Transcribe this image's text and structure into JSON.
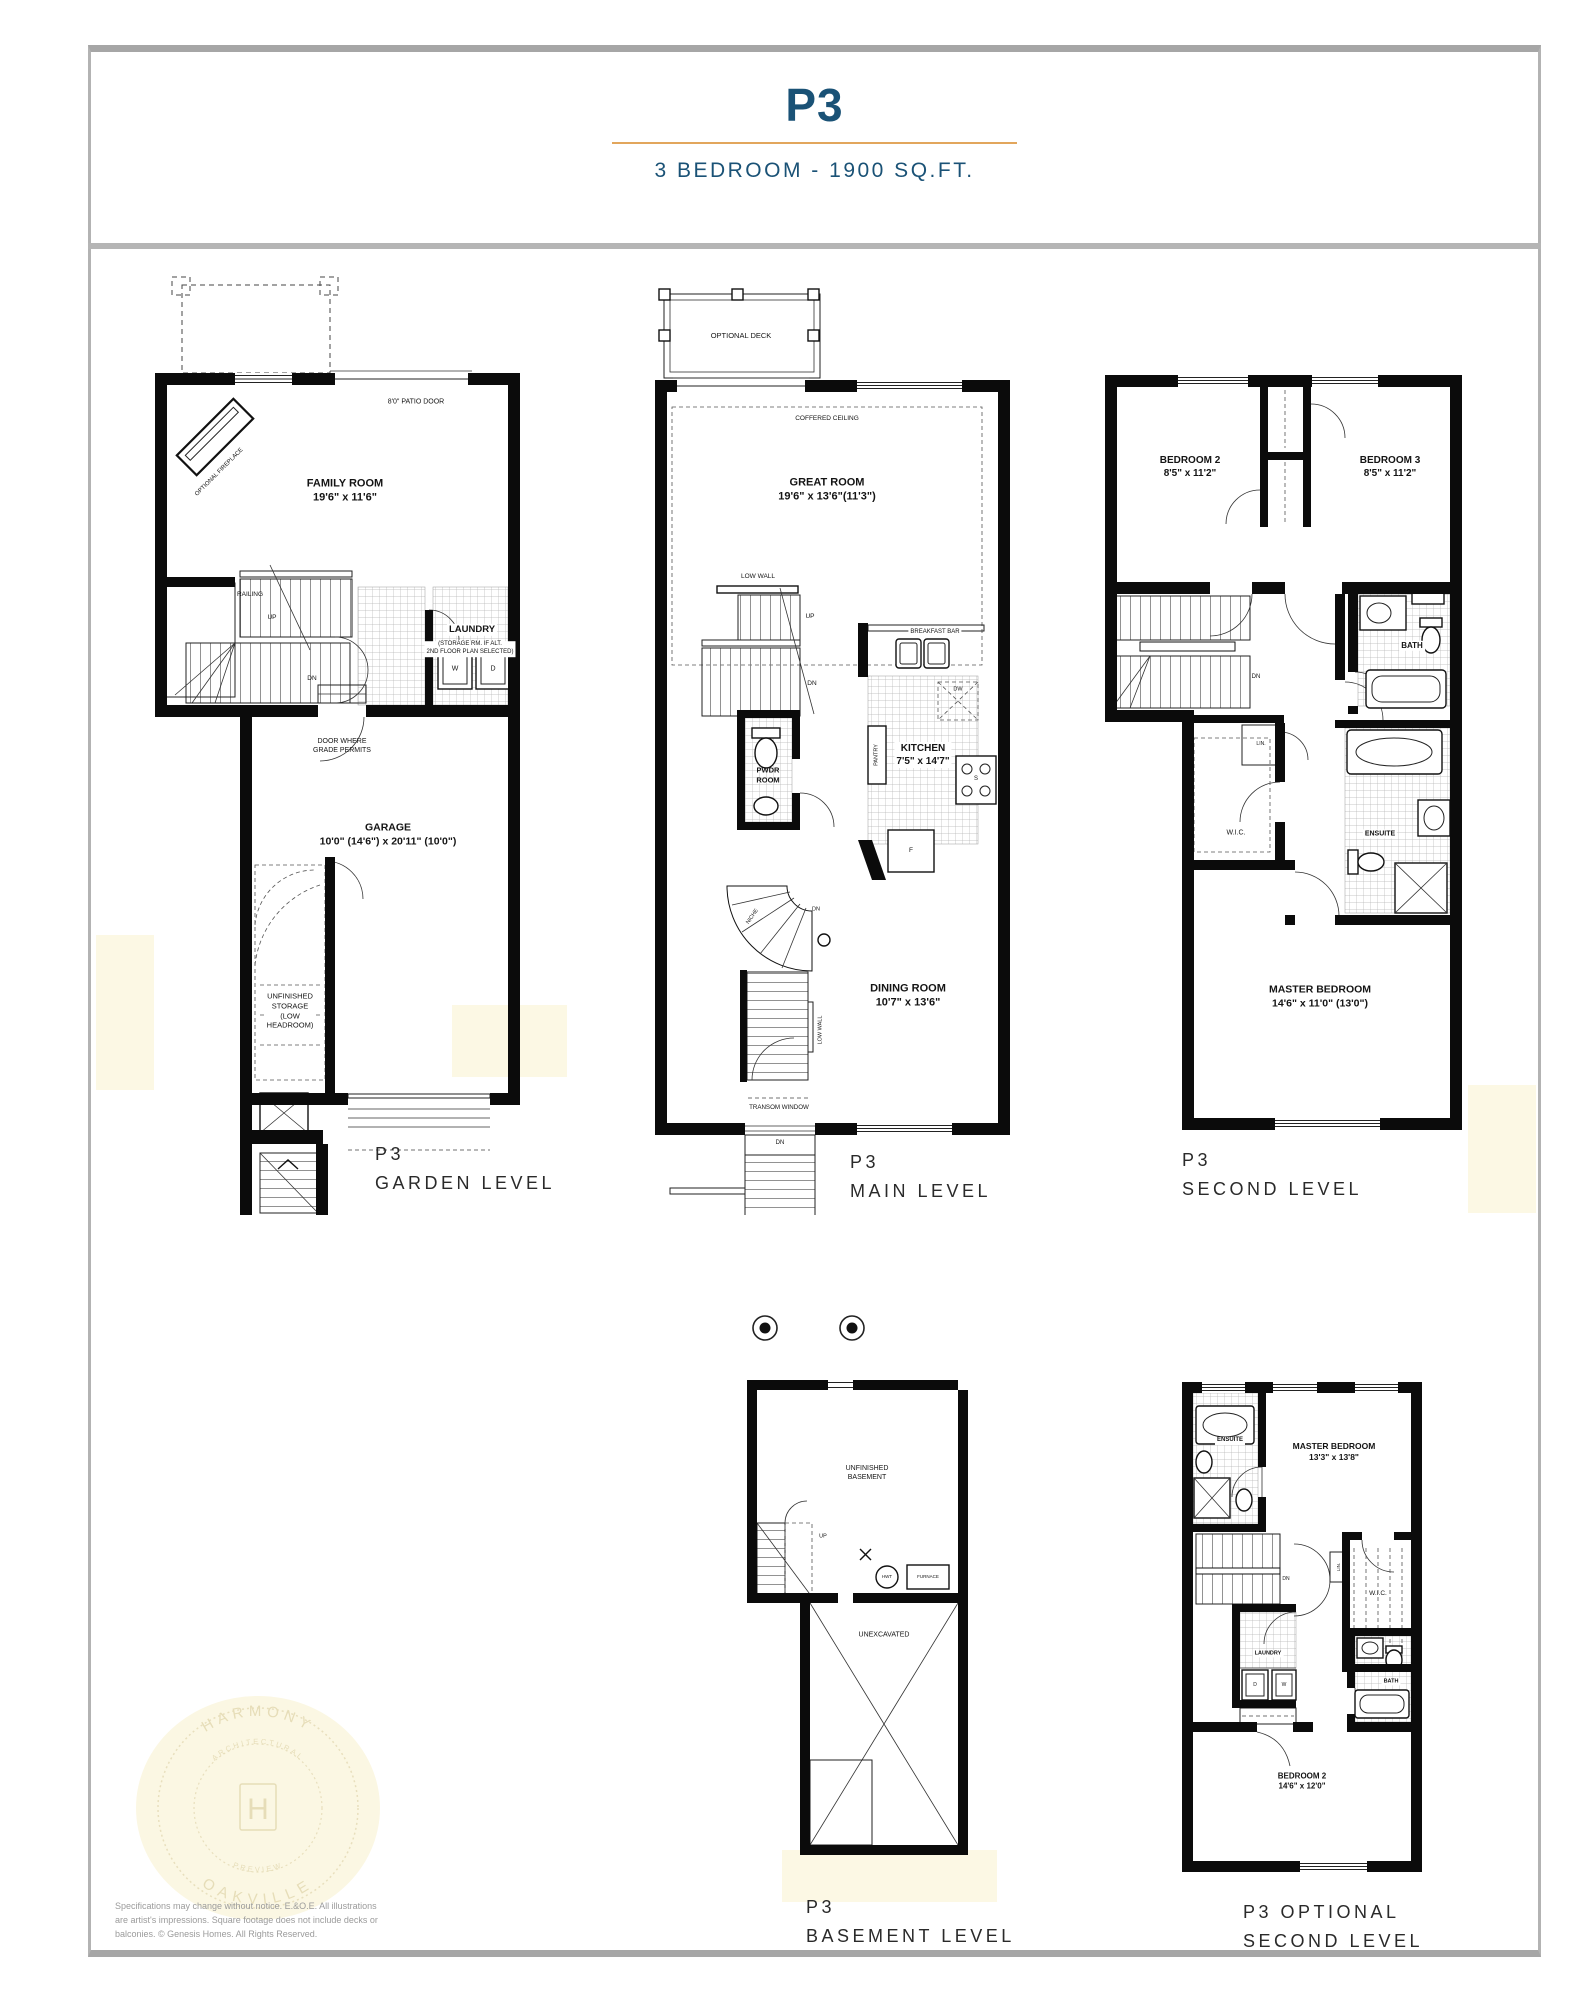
{
  "header": {
    "plan_code": "P3",
    "subtitle": "3 BEDROOM - 1900 SQ.FT."
  },
  "plans": {
    "garden": {
      "name": "P3\nGARDEN LEVEL",
      "optional_fireplace": "OPTIONAL FIREPLACE",
      "patio_door": "8'0\" PATIO DOOR",
      "family_room": "FAMILY ROOM\n19'6\" x 11'6\"",
      "railing": "RAILING",
      "up": "UP",
      "dn": "DN",
      "laundry": "LAUNDRY",
      "laundry_note": "(STORAGE RM. IF ALT.\n2ND FLOOR PLAN SELECTED)",
      "washer": "W",
      "dryer": "D",
      "door_grade": "DOOR WHERE\nGRADE PERMITS",
      "garage": "GARAGE\n10'0\" (14'6\") x 20'11\" (10'0\")",
      "storage": "UNFINISHED\nSTORAGE\n(LOW\nHEADROOM)"
    },
    "main": {
      "name": "P3\nMAIN LEVEL",
      "optional_deck": "OPTIONAL DECK",
      "coffered_ceiling": "COFFERED CEILING",
      "great_room": "GREAT ROOM\n19'6\" x 13'6\"(11'3\")",
      "low_wall": "LOW WALL",
      "up": "UP",
      "dn": "DN",
      "breakfast_bar": "BREAKFAST BAR",
      "kitchen": "KITCHEN\n7'5\" x 14'7\"",
      "pantry": "PANTRY",
      "dw": "DW",
      "stove": "S",
      "fridge": "F",
      "pwdr_room": "PWDR\nROOM",
      "niche": "NICHE",
      "dining_room": "DINING ROOM\n10'7\" x 13'6\"",
      "transom_window": "TRANSOM WINDOW"
    },
    "second": {
      "name": "P3\nSECOND LEVEL",
      "bedroom2": "BEDROOM 2\n8'5\" x 11'2\"",
      "bedroom3": "BEDROOM 3\n8'5\" x 11'2\"",
      "bath": "BATH",
      "dn": "DN",
      "linen": "LIN.",
      "wic": "W.I.C.",
      "ensuite": "ENSUITE",
      "master": "MASTER BEDROOM\n14'6\" x 11'0\" (13'0\")"
    },
    "basement": {
      "name": "P3\nBASEMENT LEVEL",
      "unfinished": "UNFINISHED\nBASEMENT",
      "up": "UP",
      "hwt": "HWT",
      "furnace": "FURNACE",
      "unexcavated": "UNEXCAVATED"
    },
    "optional": {
      "name": "P3 OPTIONAL\nSECOND LEVEL",
      "ensuite": "ENSUITE",
      "master": "MASTER BEDROOM\n13'3\" x 13'8\"",
      "dn": "DN",
      "linen": "LIN.",
      "wic": "W.I.C.",
      "laundry": "LAUNDRY",
      "dryer": "D",
      "washer": "W",
      "bath": "BATH",
      "bedroom2": "BEDROOM 2\n14'6\" x 12'0\""
    }
  },
  "watermark": {
    "top": "HARMONY",
    "inner_top": "ARCHITECTURAL",
    "monogram": "H",
    "inner_bottom": "PREVIEW",
    "bottom": "OAKVILLE"
  },
  "disclaimer": "Specifications may change without notice. E.&O.E. All illustrations\nare artist's impressions. Square footage does not include decks or\nbalconies. © Genesis Homes. All Rights Reserved.",
  "colors": {
    "accent_blue": "#1A5276",
    "accent_orange": "#E2A65C",
    "wall_black": "#0B0B0B"
  }
}
